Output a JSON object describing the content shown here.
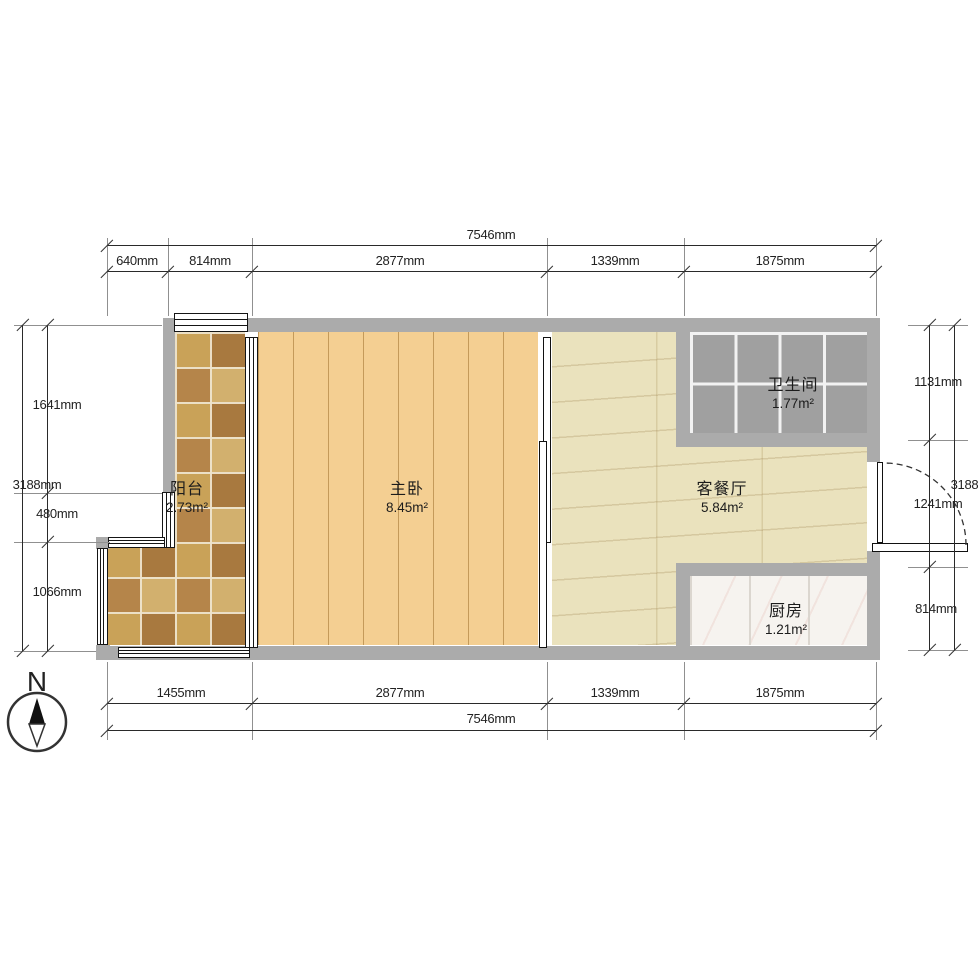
{
  "rooms": [
    {
      "name": "阳台",
      "area": "2.73m²"
    },
    {
      "name": "主卧",
      "area": "8.45m²"
    },
    {
      "name": "卫生间",
      "area": "1.77m²"
    },
    {
      "name": "客餐厅",
      "area": "5.84m²"
    },
    {
      "name": "厨房",
      "area": "1.21m²"
    }
  ],
  "dims": {
    "top": {
      "total": "7546mm",
      "segments": [
        "640mm",
        "814mm",
        "2877mm",
        "1339mm",
        "1875mm"
      ]
    },
    "bottom": {
      "total": "7546mm",
      "segments": [
        "1455mm",
        "2877mm",
        "1339mm",
        "1875mm"
      ]
    },
    "left": {
      "total": "3188mm",
      "segments": [
        "1641mm",
        "480mm",
        "1066mm"
      ]
    },
    "right": {
      "total": "3188mm",
      "segments": [
        "1131mm",
        "1241mm",
        "814mm"
      ]
    }
  },
  "compass": {
    "north_label": "N"
  },
  "colors": {
    "wall": "#ababab",
    "wood": "#f4cf92",
    "marble": "#eae2bd",
    "bath_tile": "#a0a0a0",
    "kitchen_tile": "#f6f3ef",
    "balcony_dark": "#a8793f",
    "balcony_light": "#d2b06e",
    "balcony_mid1": "#c9a258",
    "balcony_mid2": "#b5854a"
  }
}
